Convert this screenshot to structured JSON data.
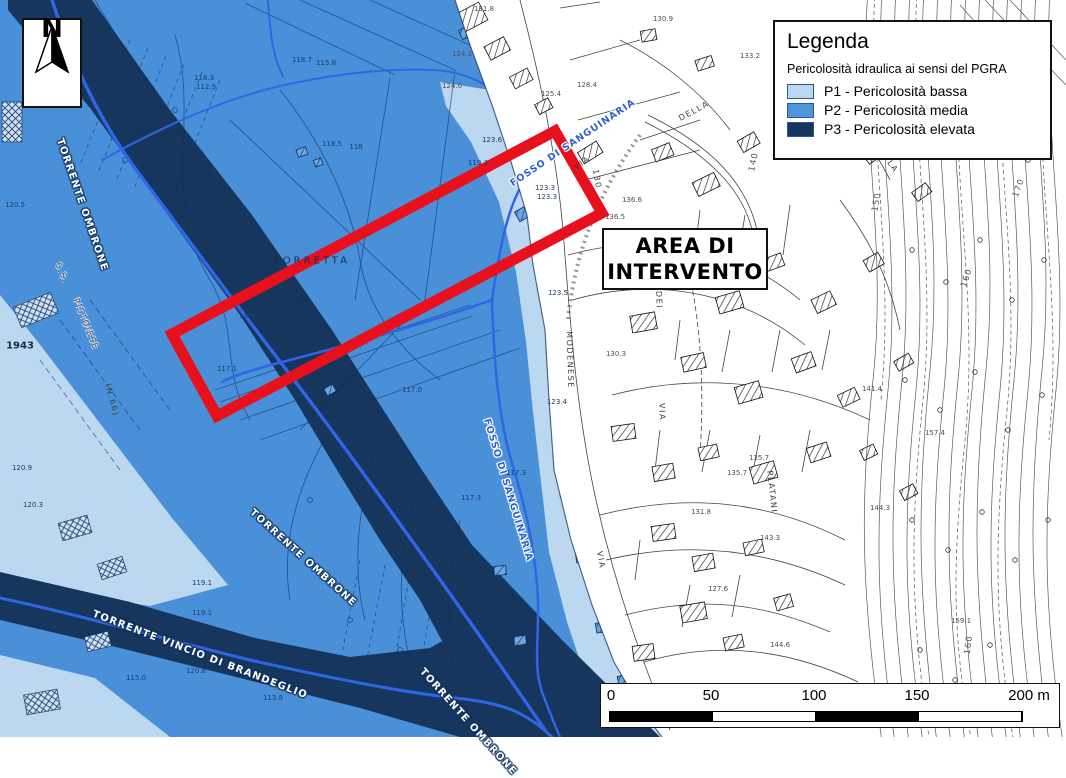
{
  "north": {
    "label": "N"
  },
  "legend": {
    "title": "Legenda",
    "subtitle": "Pericolosità idraulica ai sensi del PGRA",
    "items": [
      {
        "code": "P1",
        "label": "P1 - Pericolosità bassa",
        "color": "#BCD7F0"
      },
      {
        "code": "P2",
        "label": "P2 - Pericolosità media",
        "color": "#4E95DA"
      },
      {
        "code": "P3",
        "label": "P3 - Pericolosità elevata",
        "color": "#16365E"
      }
    ]
  },
  "area_box": {
    "line1": "AREA DI",
    "line2": "INTERVENTO"
  },
  "scalebar": {
    "ticks": [
      "0",
      "50",
      "100",
      "150",
      "200 m"
    ]
  },
  "colors": {
    "p1": "#BCD7F0",
    "p2": "#4A90D8",
    "p3": "#16365E",
    "stream_blue": "#2E66E5",
    "red_frame": "#E8101C"
  },
  "labels": {
    "streams": [
      {
        "t": "TORRENTE OMBRONE",
        "x": 82,
        "y": 205,
        "rot": 71,
        "cls": "st-w",
        "n": "label-torrente-ombrone-upper"
      },
      {
        "t": "TORRENTE OMBRONE",
        "x": 303,
        "y": 558,
        "rot": 42,
        "cls": "st-w",
        "n": "label-torrente-ombrone-lower"
      },
      {
        "t": "TORRENTE VINCIO DI BRANDEGLIO",
        "x": 200,
        "y": 655,
        "rot": 21,
        "cls": "st-w",
        "n": "label-torrente-vincio"
      },
      {
        "t": "TORRENTE OMBRONE",
        "x": 468,
        "y": 722,
        "rot": 48,
        "cls": "st-w",
        "n": "label-torrente-ombrone-bottom"
      },
      {
        "t": "FOSSO DI SANGUINARIA",
        "x": 573,
        "y": 143,
        "rot": -34,
        "cls": "st-b",
        "n": "label-fosso-sanguinaria-upper"
      },
      {
        "t": "FOSSO DI SANGUINARIA",
        "x": 508,
        "y": 490,
        "rot": 73,
        "cls": "st-b",
        "n": "label-fosso-sanguinaria-lower"
      }
    ],
    "roads": [
      {
        "t": "S.S.",
        "x": 62,
        "y": 273,
        "rot": 66,
        "cls": "rd rd-h",
        "n": "label-ss"
      },
      {
        "t": "PISTOIESE",
        "x": 86,
        "y": 324,
        "rot": 68,
        "cls": "rd rd-h",
        "n": "label-pistoiese"
      },
      {
        "t": "VIA",
        "x": 582,
        "y": 163,
        "rot": -36,
        "cls": "rd",
        "n": "label-via"
      },
      {
        "t": "130",
        "x": 597,
        "y": 179,
        "rot": 80,
        "cls": "rd",
        "n": "label-130"
      },
      {
        "t": "MODENESE",
        "x": 570,
        "y": 360,
        "rot": 88,
        "cls": "rd",
        "n": "label-modenese"
      },
      {
        "t": "DEI",
        "x": 659,
        "y": 300,
        "rot": 88,
        "cls": "rd",
        "n": "label-dei"
      },
      {
        "t": "VIA",
        "x": 662,
        "y": 412,
        "rot": 88,
        "cls": "rd",
        "n": "label-via-2"
      },
      {
        "t": "VIA",
        "x": 601,
        "y": 560,
        "rot": 80,
        "cls": "rd",
        "n": "label-via-3"
      },
      {
        "t": "PLATANI",
        "x": 772,
        "y": 492,
        "rot": 84,
        "cls": "rd",
        "n": "label-platani"
      },
      {
        "t": "DELLA",
        "x": 694,
        "y": 111,
        "rot": -28,
        "cls": "rd",
        "n": "label-della"
      },
      {
        "t": "PLA",
        "x": 891,
        "y": 164,
        "rot": 55,
        "cls": "rd",
        "n": "label-pla"
      },
      {
        "t": "(N.66)",
        "x": 112,
        "y": 400,
        "rot": 75,
        "cls": "rd",
        "n": "label-n66"
      }
    ],
    "places": [
      {
        "t": "FORRETTA",
        "x": 312,
        "y": 261,
        "cls": "pl",
        "n": "label-forretta"
      },
      {
        "t": "1943",
        "x": 20,
        "y": 346,
        "cls": "yr",
        "n": "label-1943"
      }
    ],
    "elevations": [
      {
        "t": "119.2",
        "x": 82,
        "y": 12,
        "cls": "ev"
      },
      {
        "t": "118.3",
        "x": 204,
        "y": 78,
        "cls": "ev"
      },
      {
        "t": "112.9",
        "x": 206,
        "y": 87,
        "cls": "ev"
      },
      {
        "t": "118.7",
        "x": 302,
        "y": 60,
        "cls": "ev"
      },
      {
        "t": "115.8",
        "x": 326,
        "y": 63,
        "cls": "ev"
      },
      {
        "t": "118.5",
        "x": 332,
        "y": 144,
        "cls": "ev"
      },
      {
        "t": "118",
        "x": 356,
        "y": 147,
        "cls": "ev"
      },
      {
        "t": "123.6",
        "x": 492,
        "y": 140,
        "cls": "ev"
      },
      {
        "t": "119.3",
        "x": 478,
        "y": 163,
        "cls": "ev"
      },
      {
        "t": "116.7",
        "x": 259,
        "y": 242,
        "cls": "ev"
      },
      {
        "t": "119.1",
        "x": 249,
        "y": 316,
        "cls": "ev"
      },
      {
        "t": "117.1",
        "x": 227,
        "y": 369,
        "cls": "ev"
      },
      {
        "t": "117.0",
        "x": 412,
        "y": 390,
        "cls": "ev"
      },
      {
        "t": "117.3",
        "x": 471,
        "y": 498,
        "cls": "ev"
      },
      {
        "t": "117.3",
        "x": 516,
        "y": 473,
        "cls": "ev"
      },
      {
        "t": "120.5",
        "x": 15,
        "y": 205,
        "cls": "ev"
      },
      {
        "t": "120.9",
        "x": 22,
        "y": 468,
        "cls": "ev"
      },
      {
        "t": "120.3",
        "x": 33,
        "y": 505,
        "cls": "ev"
      },
      {
        "t": "119.1",
        "x": 202,
        "y": 583,
        "cls": "ev"
      },
      {
        "t": "119.1",
        "x": 202,
        "y": 613,
        "cls": "ev"
      },
      {
        "t": "120.8",
        "x": 196,
        "y": 671,
        "cls": "ev"
      },
      {
        "t": "115.0",
        "x": 136,
        "y": 678,
        "cls": "ev"
      },
      {
        "t": "113.8",
        "x": 273,
        "y": 698,
        "cls": "ev"
      },
      {
        "t": "113.8",
        "x": 358,
        "y": 700,
        "cls": "ev"
      },
      {
        "t": "123.3",
        "x": 545,
        "y": 188,
        "cls": "ev"
      },
      {
        "t": "123.3",
        "x": 547,
        "y": 197,
        "cls": "ev"
      },
      {
        "t": "123.5",
        "x": 558,
        "y": 293,
        "cls": "ev"
      },
      {
        "t": "123.4",
        "x": 557,
        "y": 402,
        "cls": "ev"
      },
      {
        "t": "131.8",
        "x": 484,
        "y": 9,
        "cls": "ev-g"
      },
      {
        "t": "124.1",
        "x": 462,
        "y": 54,
        "cls": "ev-g"
      },
      {
        "t": "124.0",
        "x": 452,
        "y": 86,
        "cls": "ev-g"
      },
      {
        "t": "125.4",
        "x": 551,
        "y": 94,
        "cls": "ev-g"
      },
      {
        "t": "128.4",
        "x": 587,
        "y": 85,
        "cls": "ev-g"
      },
      {
        "t": "130.9",
        "x": 663,
        "y": 19,
        "cls": "ev-g"
      },
      {
        "t": "133.2",
        "x": 750,
        "y": 56,
        "cls": "ev-g"
      },
      {
        "t": "136.6",
        "x": 632,
        "y": 200,
        "cls": "ev-g"
      },
      {
        "t": "136.5",
        "x": 615,
        "y": 217,
        "cls": "ev-g"
      },
      {
        "t": "130.3",
        "x": 616,
        "y": 354,
        "cls": "ev-g"
      },
      {
        "t": "135.7",
        "x": 759,
        "y": 458,
        "cls": "ev-g"
      },
      {
        "t": "135.7",
        "x": 737,
        "y": 473,
        "cls": "ev-g"
      },
      {
        "t": "131.8",
        "x": 701,
        "y": 512,
        "cls": "ev-g"
      },
      {
        "t": "127.6",
        "x": 718,
        "y": 589,
        "cls": "ev-g"
      },
      {
        "t": "144.6",
        "x": 780,
        "y": 645,
        "cls": "ev-g"
      },
      {
        "t": "143.3",
        "x": 770,
        "y": 538,
        "cls": "ev-g"
      },
      {
        "t": "141.4",
        "x": 872,
        "y": 389,
        "cls": "ev-g"
      },
      {
        "t": "144.3",
        "x": 880,
        "y": 508,
        "cls": "ev-g"
      },
      {
        "t": "157.4",
        "x": 935,
        "y": 433,
        "cls": "ev-g"
      },
      {
        "t": "159.1",
        "x": 961,
        "y": 621,
        "cls": "ev-g"
      }
    ],
    "contours": [
      {
        "t": "140",
        "x": 754,
        "y": 162,
        "rot": -78,
        "cls": "ct"
      },
      {
        "t": "150",
        "x": 877,
        "y": 202,
        "rot": -80,
        "cls": "ct"
      },
      {
        "t": "160",
        "x": 967,
        "y": 278,
        "rot": -72,
        "cls": "ct"
      },
      {
        "t": "170",
        "x": 1019,
        "y": 188,
        "rot": -70,
        "cls": "ct"
      },
      {
        "t": "170",
        "x": 1041,
        "y": 48,
        "rot": -62,
        "cls": "ct"
      },
      {
        "t": "160",
        "x": 969,
        "y": 645,
        "rot": -82,
        "cls": "ct"
      }
    ]
  }
}
